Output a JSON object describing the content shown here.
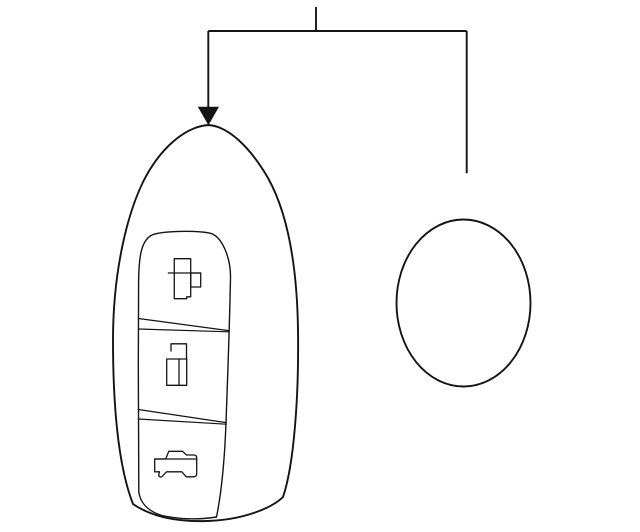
{
  "canvas": {
    "width": "640",
    "height": "532"
  },
  "colors": {
    "background": "#ffffff",
    "line": "#141414"
  },
  "diagram": {
    "kind": "parts-line-drawing",
    "parts": [
      {
        "name": "callout-leader-line",
        "shape": "bracket with down arrow"
      },
      {
        "name": "keyfob-remote-body",
        "shape": "egg-shaped outline"
      },
      {
        "name": "keyfob-button-panel",
        "shape": "rounded inset panel"
      },
      {
        "name": "lock-button-icon",
        "shape": "rect with bar and tab"
      },
      {
        "name": "unlock-button-icon",
        "shape": "open padlock"
      },
      {
        "name": "trunk-release-button-icon",
        "shape": "car silhouette"
      },
      {
        "name": "oval-part",
        "shape": "ellipse outline"
      }
    ]
  }
}
